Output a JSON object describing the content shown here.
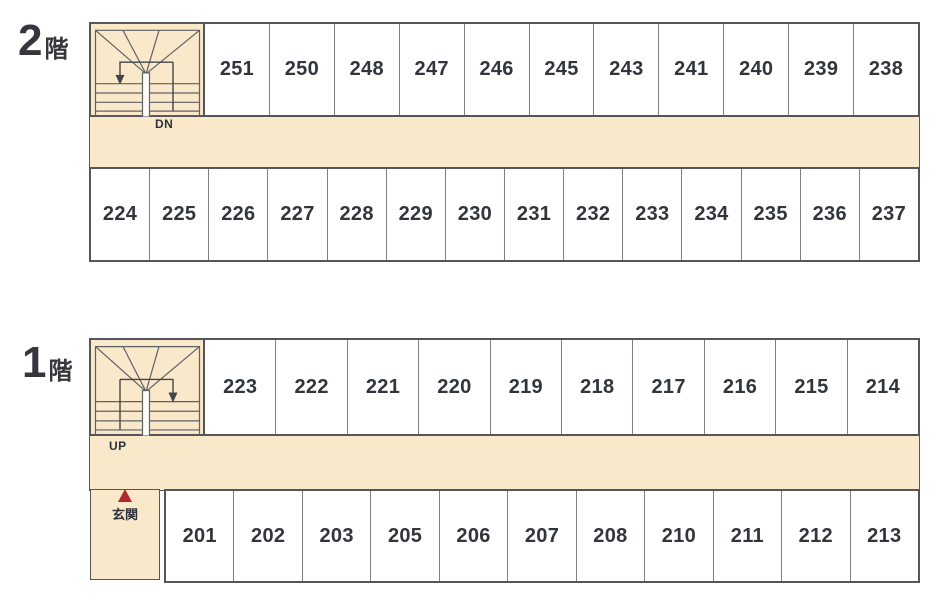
{
  "palette": {
    "corridor_beige": "#fae8cb",
    "wall_dark": "#55565a",
    "divider_gray": "#7c7e83",
    "room_text": "#31353c",
    "entrance_red": "#b2282b",
    "room_bg": "#ffffff"
  },
  "floors": {
    "second": {
      "name_number": "2",
      "name_suffix": "階",
      "stair_label": "DN",
      "upper_rooms": [
        "251",
        "250",
        "248",
        "247",
        "246",
        "245",
        "243",
        "241",
        "240",
        "239",
        "238"
      ],
      "lower_rooms": [
        "224",
        "225",
        "226",
        "227",
        "228",
        "229",
        "230",
        "231",
        "232",
        "233",
        "234",
        "235",
        "236",
        "237"
      ]
    },
    "first": {
      "name_number": "1",
      "name_suffix": "階",
      "stair_label": "UP",
      "entrance_label": "玄関",
      "upper_rooms": [
        "223",
        "222",
        "221",
        "220",
        "219",
        "218",
        "217",
        "216",
        "215",
        "214"
      ],
      "lower_rooms": [
        "201",
        "202",
        "203",
        "205",
        "206",
        "207",
        "208",
        "210",
        "211",
        "212",
        "213"
      ]
    }
  }
}
